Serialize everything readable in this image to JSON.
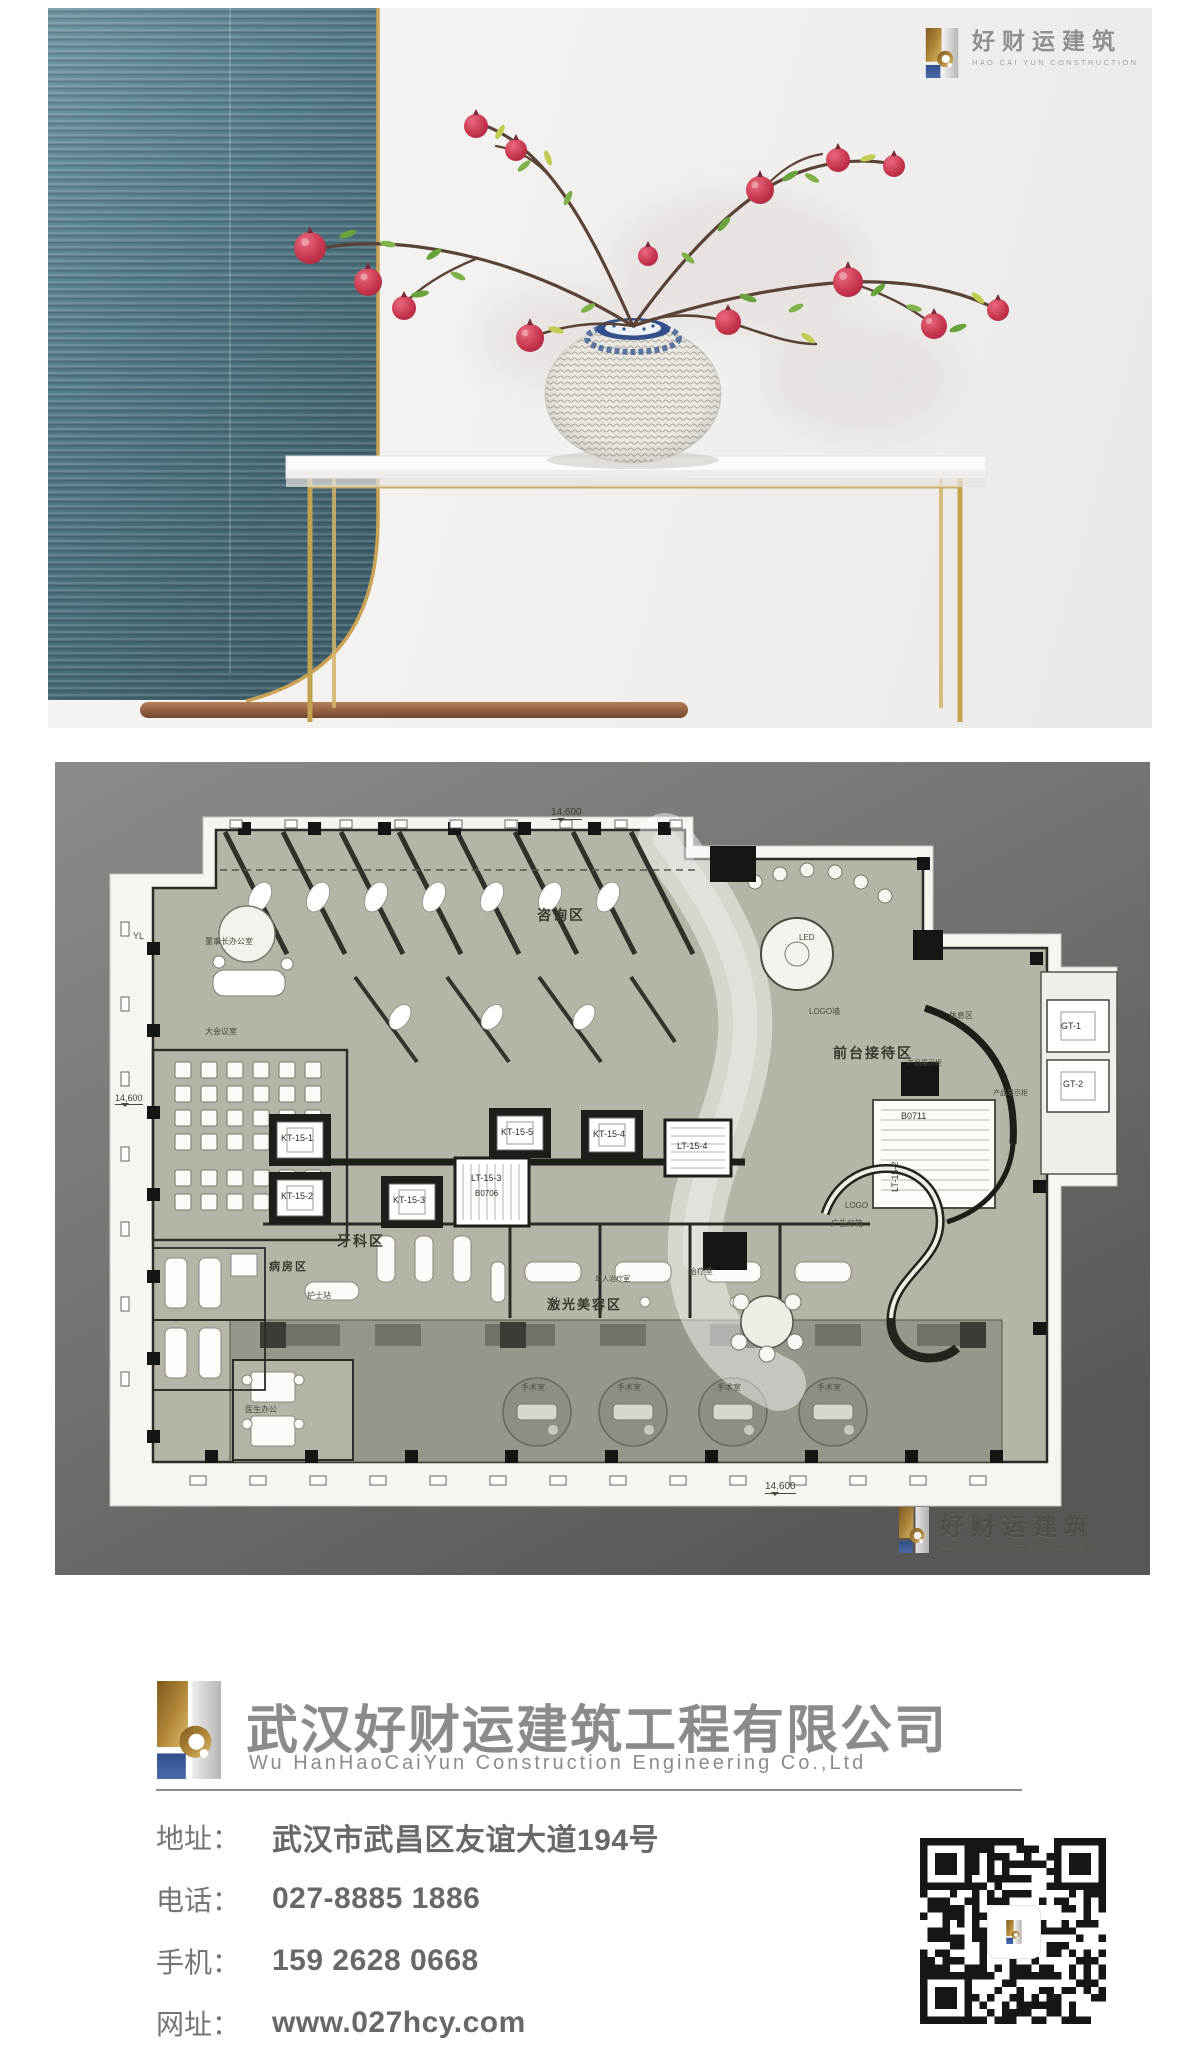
{
  "brand": {
    "logo_cn": "好财运建筑",
    "logo_en": "HAO CAI YUN CONSTRUCTION",
    "colors": {
      "gold": "#b3893a",
      "blue": "#3c5b97",
      "gray_panel": "#c9c9c9",
      "text_gray": "#8b8b8b"
    }
  },
  "footer": {
    "company_cn": "武汉好财运建筑工程有限公司",
    "company_en": "Wu HanHaoCaiYun Construction Engineering Co.,Ltd",
    "contacts": [
      {
        "label": "地址：",
        "value": "武汉市武昌区友谊大道194号"
      },
      {
        "label": "电话：",
        "value": "027-8885 1886"
      },
      {
        "label": "手机：",
        "value": "159 2628 0668"
      },
      {
        "label": "网址：",
        "value": "www.027hcy.com"
      }
    ]
  },
  "floor_plan": {
    "watermark_cn": "好财运建筑",
    "watermark_en": "HAO CAI YUN CONSTRUCTION",
    "dimensions": {
      "top": "14,600",
      "left": "14,600",
      "bottom": "14.600"
    },
    "labels": [
      {
        "text": "14,600",
        "x": 496,
        "y": 46,
        "size": 10,
        "color": "#3f3e36",
        "dim": true
      },
      {
        "text": "14,600",
        "x": 60,
        "y": 332,
        "size": 9,
        "color": "#3f3e36",
        "dim": true
      },
      {
        "text": "14.600",
        "x": 710,
        "y": 720,
        "size": 10,
        "color": "#3f3e36",
        "dim": true
      },
      {
        "text": "咨询区",
        "x": 482,
        "y": 146,
        "size": 14,
        "bold": true,
        "color": "#3a392f"
      },
      {
        "text": "前台接待区",
        "x": 778,
        "y": 284,
        "size": 14,
        "bold": true,
        "color": "#3a392f"
      },
      {
        "text": "牙科区",
        "x": 282,
        "y": 472,
        "size": 14,
        "bold": true,
        "color": "#3a392f"
      },
      {
        "text": "病房区",
        "x": 214,
        "y": 500,
        "size": 11,
        "bold": true,
        "color": "#3a392f"
      },
      {
        "text": "激光美容区",
        "x": 492,
        "y": 536,
        "size": 13,
        "bold": true,
        "color": "#3a392f"
      },
      {
        "text": "董事长办公室",
        "x": 150,
        "y": 176,
        "size": 8,
        "color": "#4a493f"
      },
      {
        "text": "大会议室",
        "x": 150,
        "y": 266,
        "size": 8,
        "color": "#4a493f"
      },
      {
        "text": "护士站",
        "x": 252,
        "y": 530,
        "size": 8,
        "color": "#4a493f"
      },
      {
        "text": "治疗室",
        "x": 634,
        "y": 506,
        "size": 8,
        "color": "#4a493f"
      },
      {
        "text": "单人治疗室",
        "x": 540,
        "y": 514,
        "size": 7,
        "color": "#4a493f"
      },
      {
        "text": "休息区",
        "x": 894,
        "y": 250,
        "size": 8,
        "color": "#4a493f"
      },
      {
        "text": "产品展示柜",
        "x": 852,
        "y": 298,
        "size": 7,
        "color": "#4a493f"
      },
      {
        "text": "产品展示柜",
        "x": 938,
        "y": 328,
        "size": 7,
        "color": "#4a493f"
      },
      {
        "text": "LOGO墙",
        "x": 754,
        "y": 246,
        "size": 8,
        "color": "#4a493f"
      },
      {
        "text": "LED",
        "x": 744,
        "y": 172,
        "size": 8,
        "color": "#4a493f"
      },
      {
        "text": "LOGO",
        "x": 790,
        "y": 440,
        "size": 8,
        "color": "#4a493f"
      },
      {
        "text": "广告灯箱",
        "x": 776,
        "y": 458,
        "size": 8,
        "color": "#4a493f"
      },
      {
        "text": "医生办公",
        "x": 190,
        "y": 644,
        "size": 8,
        "color": "#4a493f"
      },
      {
        "text": "手术室",
        "x": 466,
        "y": 622,
        "size": 8,
        "color": "#504f46"
      },
      {
        "text": "手术室",
        "x": 562,
        "y": 622,
        "size": 8,
        "color": "#504f46"
      },
      {
        "text": "手术室",
        "x": 662,
        "y": 622,
        "size": 8,
        "color": "#504f46"
      },
      {
        "text": "手术室",
        "x": 762,
        "y": 622,
        "size": 8,
        "color": "#504f46"
      },
      {
        "text": "YL",
        "x": 78,
        "y": 170,
        "size": 9,
        "color": "#4a493f"
      },
      {
        "text": "KT-15-1",
        "x": 226,
        "y": 372,
        "size": 9,
        "color": "#2e2d26"
      },
      {
        "text": "KT-15-2",
        "x": 226,
        "y": 430,
        "size": 9,
        "color": "#2e2d26"
      },
      {
        "text": "KT-15-3",
        "x": 338,
        "y": 434,
        "size": 9,
        "color": "#2e2d26"
      },
      {
        "text": "LT-15-3",
        "x": 416,
        "y": 412,
        "size": 9,
        "color": "#2e2d26"
      },
      {
        "text": "B0706",
        "x": 420,
        "y": 428,
        "size": 8,
        "color": "#2e2d26"
      },
      {
        "text": "KT-15-5",
        "x": 446,
        "y": 366,
        "size": 9,
        "color": "#2e2d26"
      },
      {
        "text": "KT-15-4",
        "x": 538,
        "y": 368,
        "size": 9,
        "color": "#2e2d26"
      },
      {
        "text": "LT-15-4",
        "x": 622,
        "y": 380,
        "size": 9,
        "color": "#2e2d26"
      },
      {
        "text": "B0711",
        "x": 846,
        "y": 350,
        "size": 9,
        "color": "#2e2d26"
      },
      {
        "text": "LT-15-2",
        "x": 836,
        "y": 430,
        "size": 9,
        "color": "#2e2d26",
        "rotate": -90
      },
      {
        "text": "GT-1",
        "x": 1006,
        "y": 260,
        "size": 9,
        "color": "#2e2d26"
      },
      {
        "text": "GT-2",
        "x": 1008,
        "y": 318,
        "size": 9,
        "color": "#2e2d26"
      }
    ]
  }
}
